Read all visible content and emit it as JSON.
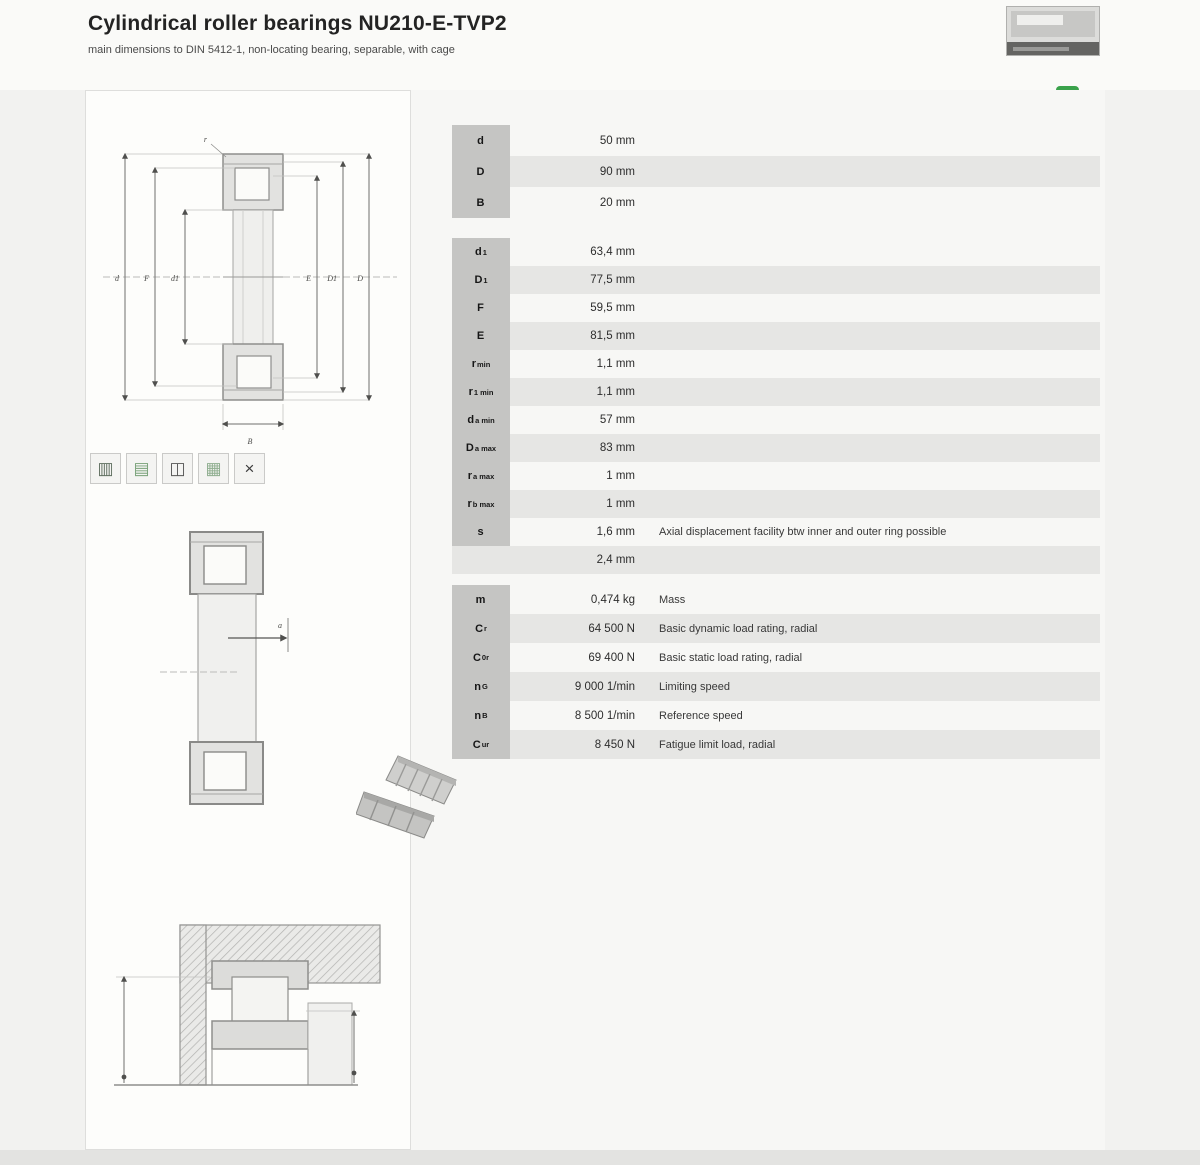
{
  "header": {
    "title": "Cylindrical roller bearings NU210-E-TVP2",
    "subtitle": "main dimensions to DIN 5412-1, non-locating bearing, separable, with cage"
  },
  "eco_badge": {
    "glyph": "↻",
    "color": "#3aa24b"
  },
  "drawings": {
    "front": {
      "left_labels": [
        "d",
        "F",
        "d1"
      ],
      "right_labels": [
        "E",
        "D1",
        "D"
      ],
      "bottom_label": "B",
      "corner_label": "r"
    },
    "section": {
      "arrow_label": "a"
    }
  },
  "icons": {
    "features": [
      {
        "name": "bearing-section-icon",
        "glyph": "▥",
        "color": "#5f6e5f"
      },
      {
        "name": "cage-type-icon",
        "glyph": "▤",
        "color": "#79a279"
      },
      {
        "name": "design-variant-icon",
        "glyph": "◫",
        "color": "#565656"
      },
      {
        "name": "lubrication-icon",
        "glyph": "▦",
        "color": "#8fae8f"
      },
      {
        "name": "suffix-icon",
        "glyph": "×",
        "color": "#3c3c3c"
      }
    ]
  },
  "table": {
    "blocks": [
      {
        "name": "main-dimensions",
        "rows": [
          {
            "label": "d",
            "sub": "",
            "value": "50 mm",
            "desc": "",
            "striped": false
          },
          {
            "label": "D",
            "sub": "",
            "value": "90 mm",
            "desc": "",
            "striped": true
          },
          {
            "label": "B",
            "sub": "",
            "value": "20 mm",
            "desc": "",
            "striped": false
          }
        ]
      },
      {
        "name": "dimensions",
        "rows": [
          {
            "label": "d",
            "sub": "1",
            "value": "63,4 mm",
            "desc": "",
            "striped": false
          },
          {
            "label": "D",
            "sub": "1",
            "value": "77,5 mm",
            "desc": "",
            "striped": true
          },
          {
            "label": "F",
            "sub": "",
            "value": "59,5 mm",
            "desc": "",
            "striped": false
          },
          {
            "label": "E",
            "sub": "",
            "value": "81,5 mm",
            "desc": "",
            "striped": true
          },
          {
            "label": "r",
            "sub": "min",
            "value": "1,1 mm",
            "desc": "",
            "striped": false
          },
          {
            "label": "r",
            "sub": "1 min",
            "value": "1,1 mm",
            "desc": "",
            "striped": true
          },
          {
            "label": "d",
            "sub": "a min",
            "value": "57 mm",
            "desc": "",
            "striped": false
          },
          {
            "label": "D",
            "sub": "a max",
            "value": "83 mm",
            "desc": "",
            "striped": true
          },
          {
            "label": "r",
            "sub": "a max",
            "value": "1 mm",
            "desc": "",
            "striped": false
          },
          {
            "label": "r",
            "sub": "b max",
            "value": "1 mm",
            "desc": "",
            "striped": true
          },
          {
            "label": "s",
            "sub": "",
            "value": "1,6 mm",
            "desc": "Axial displacement facility btw inner and outer ring possible",
            "striped": false
          },
          {
            "label": "",
            "sub": "",
            "value": "2,4 mm",
            "desc": "",
            "striped": true
          }
        ]
      },
      {
        "name": "load-ratings-speeds",
        "rows": [
          {
            "label": "m",
            "sub": "",
            "value": "0,474 kg",
            "desc": "Mass",
            "striped": false
          },
          {
            "label": "C",
            "sub": "r",
            "value": "64 500 N",
            "desc": "Basic dynamic load rating, radial",
            "striped": true
          },
          {
            "label": "C",
            "sub": "0r",
            "value": "69 400 N",
            "desc": "Basic static load rating, radial",
            "striped": false
          },
          {
            "label": "n",
            "sub": "G",
            "value": "9 000 1/min",
            "desc": "Limiting speed",
            "striped": true
          },
          {
            "label": "n",
            "sub": "B",
            "value": "8 500 1/min",
            "desc": "Reference speed",
            "striped": false
          },
          {
            "label": "C",
            "sub": "ur",
            "value": "8 450 N",
            "desc": "Fatigue limit load, radial",
            "striped": true
          }
        ]
      }
    ]
  }
}
